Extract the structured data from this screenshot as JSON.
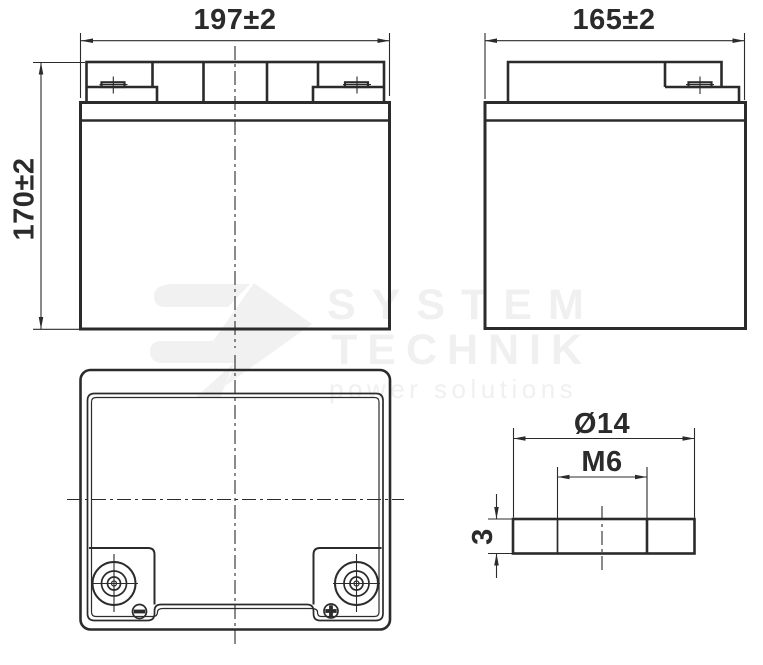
{
  "watermark": {
    "brand_line1": "SYSTEM",
    "brand_line2": "TECHNIK",
    "tagline": "power solutions"
  },
  "dimensions": {
    "front_width": "197±2",
    "front_height": "170±2",
    "side_depth": "165±2",
    "terminal_diameter": "Ø14",
    "terminal_thread": "M6",
    "terminal_disc_height": "3"
  },
  "colors": {
    "line": "#2b2b2b",
    "watermark_text": "#f0f0f0",
    "watermark_logo": "#f1f1f1",
    "background": "#ffffff"
  }
}
